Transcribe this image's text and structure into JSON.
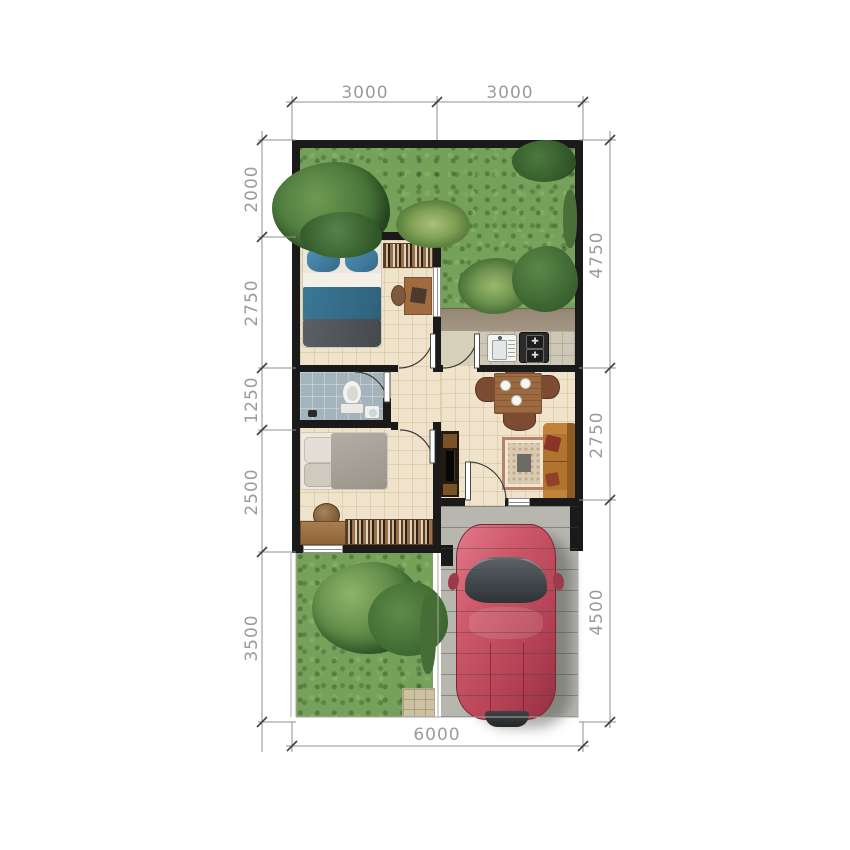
{
  "dimensions": {
    "top": [
      {
        "label": "3000"
      },
      {
        "label": "3000"
      }
    ],
    "left": [
      {
        "label": "2000"
      },
      {
        "label": "2750"
      },
      {
        "label": "1250"
      },
      {
        "label": "2500"
      },
      {
        "label": "3500"
      }
    ],
    "right": [
      {
        "label": "4750"
      },
      {
        "label": "2750"
      },
      {
        "label": "4500"
      }
    ],
    "bottom": [
      {
        "label": "6000"
      }
    ]
  },
  "icons": {
    "stove_burner": "✚"
  },
  "palette": {
    "wall": "#1a1a1a",
    "floor": "#f0e3cb",
    "grass": "#76a15a",
    "bath_floor": "#a4b4bd",
    "concrete": "#b7b6af",
    "car_body": "#c55062",
    "dim_text": "#9b9b9b",
    "wood": "#9c7347",
    "bed_blanket_blue": "#3a7895",
    "sofa": "#b1742f"
  }
}
